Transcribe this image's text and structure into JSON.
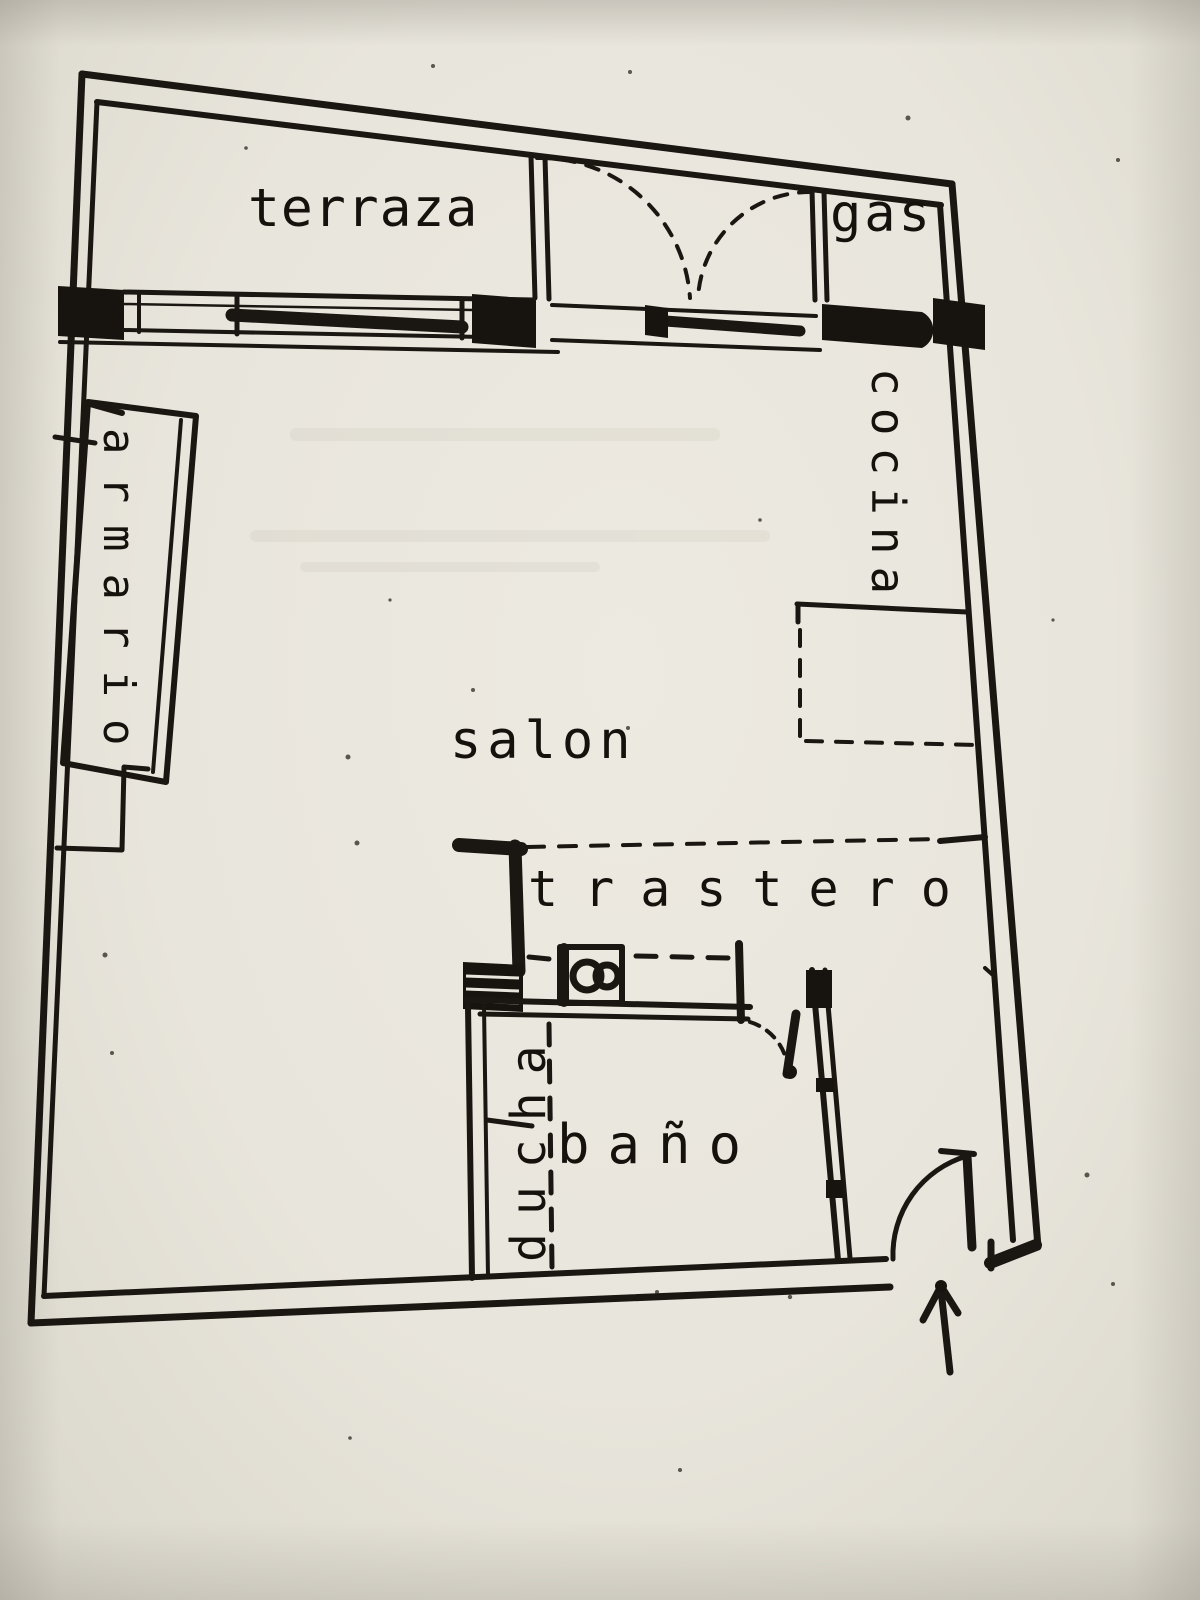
{
  "document": {
    "type": "apartment floor plan (scanned drawing)",
    "language": "Spanish"
  },
  "colors": {
    "paper": "#e8e5dc",
    "ink": "#1a1611"
  },
  "icons": {
    "entrance_arrow_icon": "↑"
  },
  "rooms": {
    "terraza": {
      "label": "terraza"
    },
    "gas": {
      "label": "gas"
    },
    "cocina": {
      "label": "cocina"
    },
    "armario": {
      "label": "armario"
    },
    "salon": {
      "label": "salon"
    },
    "trastero": {
      "label": "trastero"
    },
    "ducha": {
      "label": "ducha"
    },
    "bano": {
      "label": "baño"
    }
  }
}
